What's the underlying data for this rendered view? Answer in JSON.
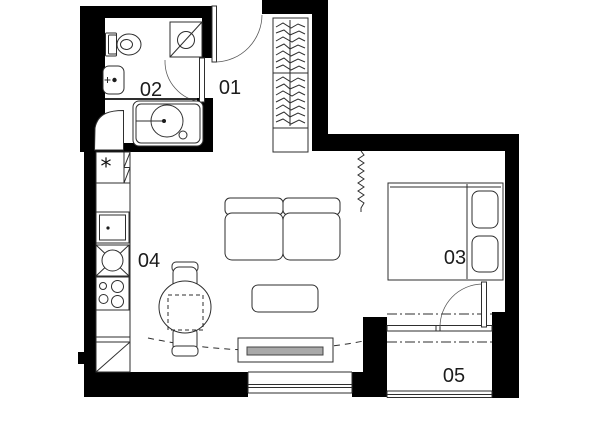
{
  "colors": {
    "wall": "#000000",
    "line": "#2e2e2e",
    "label": "#1c1c1c",
    "tv_screen": "#a9a9a9"
  },
  "rooms": [
    {
      "id": "01"
    },
    {
      "id": "02"
    },
    {
      "id": "03"
    },
    {
      "id": "04"
    },
    {
      "id": "05"
    }
  ],
  "symbols": {
    "gas_boiler": "*"
  }
}
